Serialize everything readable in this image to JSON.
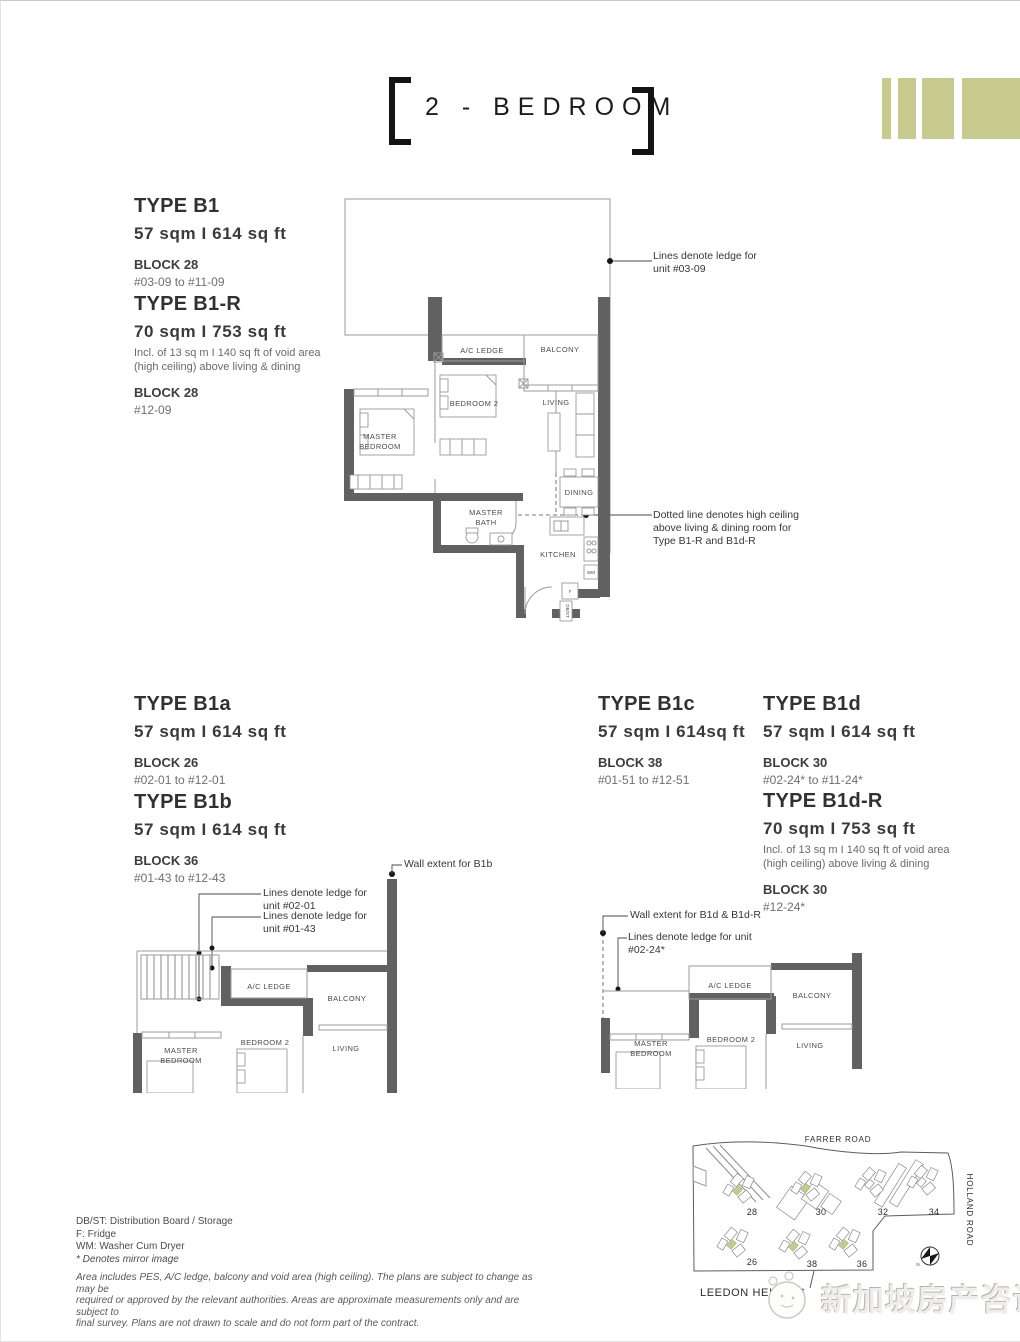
{
  "palette": {
    "olive": "#c7ca8f",
    "wall": "#616161",
    "thin_line": "#9b9b9b"
  },
  "header": {
    "title": "2 - BEDROOM"
  },
  "types": {
    "b1": {
      "name": "TYPE B1",
      "area": "57 sqm I 614 sq ft",
      "block": "BLOCK 28",
      "units": "#03-09 to #11-09"
    },
    "b1r": {
      "name": "TYPE B1-R",
      "area": "70 sqm I 753 sq ft",
      "note1": "Incl. of 13 sq m I 140 sq ft of void area",
      "note2": "(high ceiling) above living & dining",
      "block": "BLOCK 28",
      "units": "#12-09"
    },
    "b1a": {
      "name": "TYPE B1a",
      "area": "57 sqm I 614 sq ft",
      "block": "BLOCK 26",
      "units": "#02-01 to #12-01"
    },
    "b1b": {
      "name": "TYPE B1b",
      "area": "57 sqm I 614 sq ft",
      "block": "BLOCK 36",
      "units": "#01-43 to #12-43"
    },
    "b1c": {
      "name": "TYPE B1c",
      "area": "57 sqm I 614sq ft",
      "block": "BLOCK 38",
      "units": "#01-51 to #12-51"
    },
    "b1d": {
      "name": "TYPE B1d",
      "area": "57 sqm I 614 sq ft",
      "block": "BLOCK 30",
      "units": "#02-24* to #11-24*"
    },
    "b1dr": {
      "name": "TYPE B1d-R",
      "area": "70 sqm I 753 sq ft",
      "note1": "Incl. of 13 sq m I 140 sq ft of void area",
      "note2": "(high ceiling) above living & dining",
      "block": "BLOCK 30",
      "units": "#12-24*"
    }
  },
  "rooms": {
    "ac_ledge": "A/C LEDGE",
    "balcony": "BALCONY",
    "bedroom2": "BEDROOM 2",
    "living": "LIVING",
    "master1": "MASTER",
    "master2": "BEDROOM",
    "dining": "DINING",
    "bath1": "MASTER",
    "bath2": "BATH",
    "kitchen": "KITCHEN",
    "wm": "WM",
    "f": "F",
    "dbst": "DB/ST"
  },
  "annotations": {
    "main_ledge1": "Lines denote ledge for",
    "main_ledge2": "unit #03-09",
    "ceiling1": "Dotted line denotes high ceiling",
    "ceiling2": "above living & dining room for",
    "ceiling3": "Type B1-R and B1d-R",
    "b1b_wall": "Wall extent for B1b",
    "b1b_ledge_a1": "Lines denote ledge for",
    "b1b_ledge_a2": "unit #02-01",
    "b1b_ledge_b1": "Lines denote ledge for",
    "b1b_ledge_b2": "unit #01-43",
    "b1d_wall": "Wall extent for B1d & B1d-R",
    "b1d_ledge1": "Lines denote ledge for unit",
    "b1d_ledge2": "#02-24*"
  },
  "map": {
    "roads": {
      "farrer": "FARRER ROAD",
      "holland": "HOLLAND ROAD",
      "leedon": "LEEDON HEIGHTS"
    },
    "blocks": [
      "28",
      "30",
      "32",
      "34",
      "26",
      "38",
      "36"
    ],
    "compass_label": "N"
  },
  "legend": {
    "lines": [
      "DB/ST: Distribution Board / Storage",
      "F: Fridge",
      "WM: Washer Cum Dryer",
      "* Denotes mirror image"
    ],
    "disclaimer1": "Area includes PES, A/C ledge, balcony and void area (high ceiling). The plans are subject to change as may be",
    "disclaimer2": "required or approved by the relevant authorities. Areas are approximate measurements only and are subject to",
    "disclaimer3": "final survey. Plans are not drawn to scale and do not form part of the contract."
  },
  "watermark": {
    "text": "新加坡房产咨询"
  }
}
